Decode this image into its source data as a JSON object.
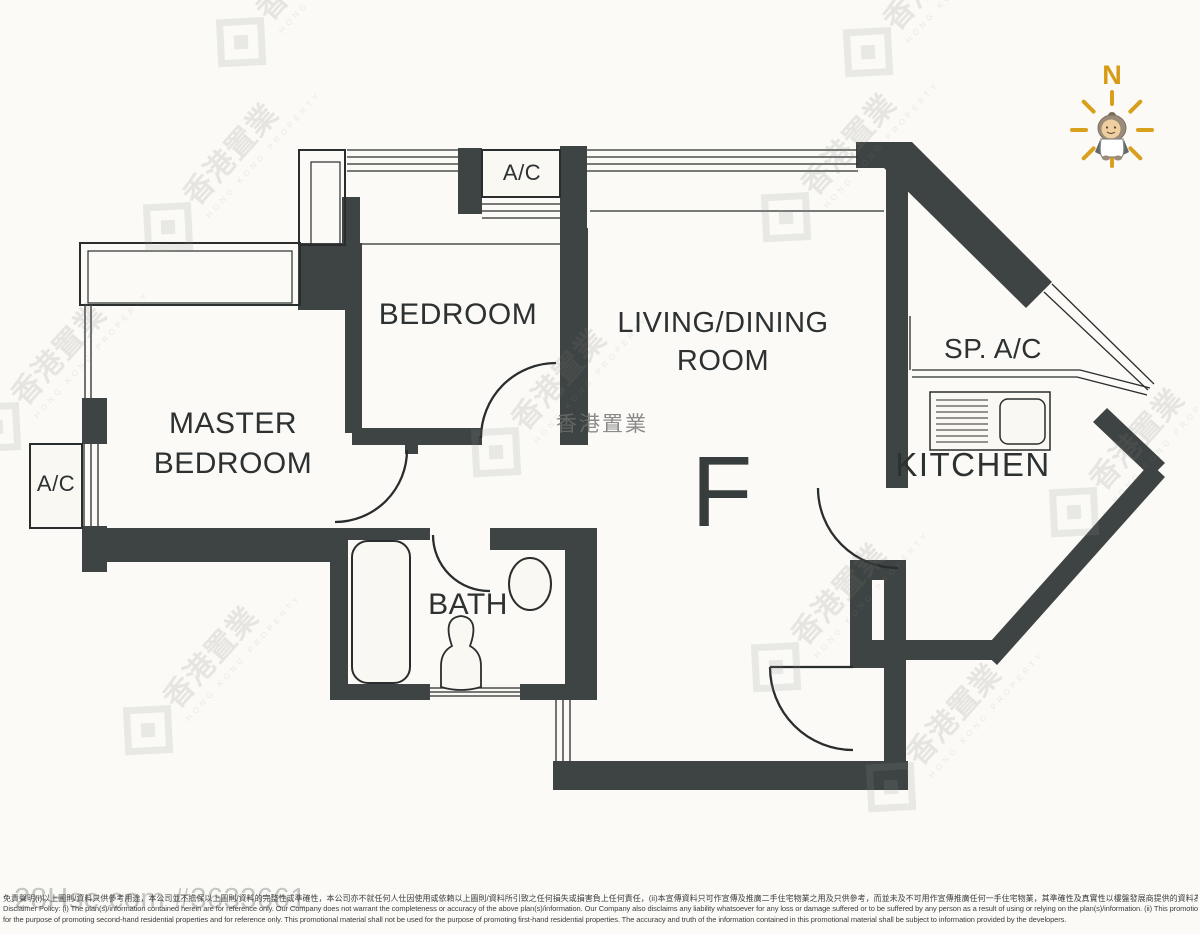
{
  "floor_plan": {
    "unit_label": "F",
    "rooms": {
      "master_bedroom": {
        "line1": "MASTER",
        "line2": "BEDROOM"
      },
      "bedroom": "BEDROOM",
      "living_dining": {
        "line1": "LIVING/DINING",
        "line2": "ROOM"
      },
      "kitchen": "KITCHEN",
      "bath": "BATH"
    },
    "fixtures": {
      "ac_top": "A/C",
      "ac_left": "A/C",
      "sp_ac": "SP. A/C"
    },
    "compass": {
      "north_label": "N"
    }
  },
  "watermark": {
    "brand_zh": "香港置業",
    "brand_en": "HONG KONG PROPERTY",
    "center_brand": "香港置業"
  },
  "footer": {
    "site_ref": "28Hse.com #3633661",
    "disclaimer_zh": "免責聲明(i)以上圖則/資料只供參考用途，本公司並不擔保以上圖則/資料的完整性或準確性，本公司亦不就任何人仕因使用或依賴以上圖則/資料所引致之任何損失或損害負上任何責任，(ii)本宣傳資料只可作宣傳及推廣二手住宅物業之用及只供參考，而並未及不可用作宣傳推廣任何一手住宅物業，其準確性及真實性以樓盤發展商提供的資料為準。",
    "disclaimer_en_line1": "Disclaimer Policy: (i) The plan(s)/information contained herein are for reference only. Our Company does not warrant the completeness or accuracy of the above plan(s)/information. Our Company also disclaims any liability whatsoever for any loss or damage suffered or to be suffered by any person as a result of using or relying on the plan(s)/information. (ii) This promotional material is",
    "disclaimer_en_line2": "for the purpose of promoting second-hand residential properties and for reference only. This promotional material shall not be used for the purpose of promoting first-hand residential properties. The accuracy and truth of the information contained in this promotional material shall be subject to information provided by the developers."
  },
  "colors": {
    "wall": "#3e4443",
    "north_accent": "#d89b15",
    "watermark_gray": "#8d8d8d",
    "site_ref_gray": "#c6c6c3"
  }
}
